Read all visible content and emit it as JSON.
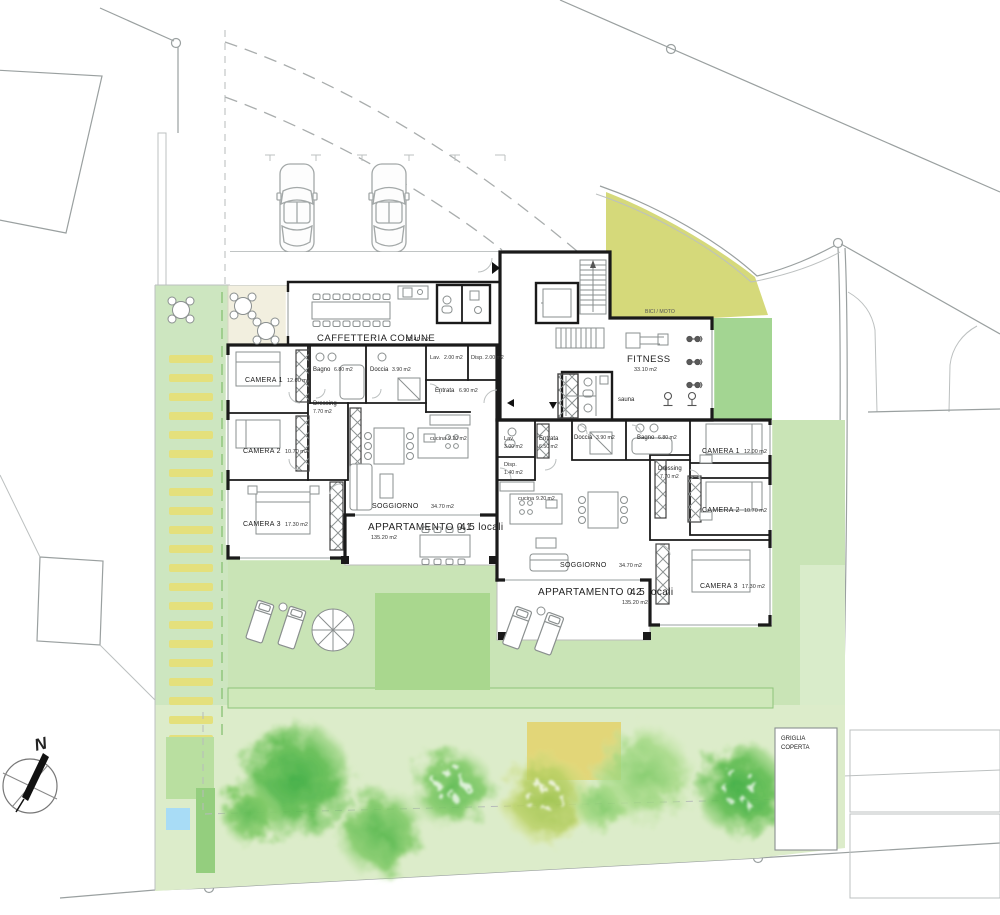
{
  "colors": {
    "garden_light": "#cfe7c0",
    "garden_band": "#dcecca",
    "garden_mid": "#a9d78e",
    "zone_bici_moto": "#d5d97a",
    "stripe_yellow": "#e4e07c",
    "terrace_beige": "#f2efdf",
    "pond_blue": "#a8dcf6",
    "sandbox_yellow": "#e2d678",
    "wall_black": "#1a1a1a",
    "line_gray": "#9aa0a0"
  },
  "compass": {
    "label": "N"
  },
  "site": {
    "bici_moto_label": "BICI / MOTO",
    "griglia_line1": "GRIGLIA",
    "griglia_line2": "COPERTA"
  },
  "common_areas": {
    "caffetteria": {
      "name": "CAFFETTERIA COMUNE",
      "area": "32.40 m2"
    },
    "fitness": {
      "name": "FITNESS",
      "area": "33.10 m2"
    },
    "sauna": {
      "name": "sauna"
    }
  },
  "apartment1": {
    "name": "APPARTAMENTO 0.1",
    "size": "4.5 locali",
    "area": "135.20 m2",
    "rooms": {
      "camera1": {
        "name": "CAMERA 1",
        "area": "12.00 m2"
      },
      "camera2": {
        "name": "CAMERA 2",
        "area": "10.70 m2"
      },
      "camera3": {
        "name": "CAMERA 3",
        "area": "17.30 m2"
      },
      "bagno": {
        "name": "Bagno",
        "area": "6.80 m2"
      },
      "doccia": {
        "name": "Doccia",
        "area": "3.90 m2"
      },
      "lav": {
        "name": "Lav.",
        "area": "2.00 m2"
      },
      "disp": {
        "name": "Disp.",
        "area": "2.00 m2"
      },
      "entrata": {
        "name": "Entrata",
        "area": "6.90 m2"
      },
      "dressing": {
        "name": "Dressing",
        "area": "7.70 m2"
      },
      "cucina": {
        "name": "cucina",
        "area": "9.20 m2"
      },
      "soggiorno": {
        "name": "SOGGIORNO",
        "area": "34.70 m2"
      }
    }
  },
  "apartment2": {
    "name": "APPARTAMENTO 0.2",
    "size": "4.5 locali",
    "area": "135.20 m2",
    "rooms": {
      "camera1": {
        "name": "CAMERA 1",
        "area": "12.00 m2"
      },
      "camera2": {
        "name": "CAMERA 2",
        "area": "10.70 m2"
      },
      "camera3": {
        "name": "CAMERA 3",
        "area": "17.30 m2"
      },
      "bagno": {
        "name": "Bagno",
        "area": "6.80 m2"
      },
      "doccia": {
        "name": "Doccia",
        "area": "3.90 m2"
      },
      "lav": {
        "name": "Lav.",
        "area": "3.00 m2"
      },
      "disp": {
        "name": "Disp.",
        "area": "1.40 m2"
      },
      "entrata": {
        "name": "Entrata",
        "area": "6.50 m2"
      },
      "dressing": {
        "name": "Dressing",
        "area": "7.70 m2"
      },
      "cucina": {
        "name": "cucina",
        "area": "9.20 m2"
      },
      "soggiorno": {
        "name": "SOGGIORNO",
        "area": "34.70 m2"
      }
    }
  }
}
